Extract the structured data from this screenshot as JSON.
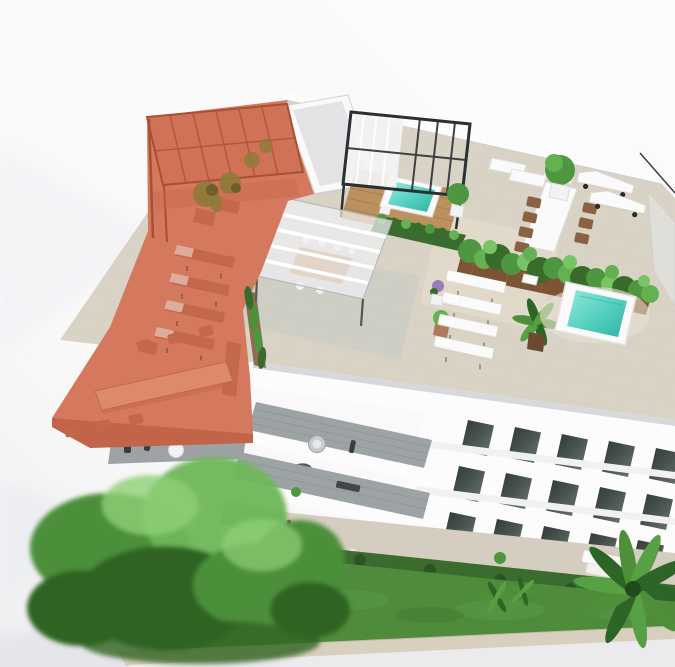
{
  "scene": {
    "type": "aerial 3d architectural rendering",
    "subject": "white residential building with furnished rooftop terraces and gardens",
    "background": "plain white studio backdrop",
    "highlighted_unit": {
      "position": "rooftop upper-left terrace",
      "state": "selected",
      "tint": "#d4795e",
      "furniture": [
        "slatted pergola",
        "potted trees x2",
        "sun loungers x4",
        "dining table",
        "chairs x6",
        "side benches"
      ]
    },
    "rooftop_features": [
      "white skylight box",
      "black glass pergola",
      "timber deck",
      "plunge pool 1",
      "white slat pergola",
      "pergola dining table with chairs",
      "long dining table",
      "brown chairs",
      "hedge planter",
      "large timber planter with shrubs",
      "white sun loungers x4",
      "wheeled loungers x2",
      "daybeds x2",
      "potted palm",
      "lavender pots",
      "potted shrubs",
      "plunge pool 2",
      "glass edge railing",
      "ornamental grasses"
    ],
    "facade_features": [
      "roof fascia",
      "dark window rows x3",
      "floor slab bands",
      "stepped balcony terraces x3",
      "hanging chair",
      "balcony rug",
      "balcony figures",
      "round table"
    ],
    "ground_features": [
      "stone patio",
      "white outdoor sofa",
      "round poufs",
      "cafe table and chairs",
      "figure in red",
      "hedge row",
      "lawn",
      "small palms x2",
      "large tree",
      "tall palm",
      "beige boundary wall"
    ]
  },
  "colors": {
    "bg": "#fbfafa",
    "bgSoft": "#f2f1f4",
    "shadowSoft": "#e4e5e9",
    "groundStrip": "#ebebee",
    "wallBeige": "#d9cfbe",
    "patio": "#d5cec0",
    "lawn": "#4e8c3c",
    "lawnLight": "#5da04a",
    "lawnDark": "#3f7a30",
    "hedge": "#3a6b2f",
    "hedgeDark": "#2c5424",
    "treeDark": "#2f6423",
    "treeMid": "#4c8f3a",
    "treeLight": "#6fb659",
    "treeTip": "#8fd077",
    "palmDark": "#2d6526",
    "palmMid": "#4e9039",
    "palmLight": "#57a044",
    "roofPaver": "#d9d3c6",
    "paverLine": "#c6c0b2",
    "paverCool": "#c4c8c3",
    "paverWarm": "#e7e0d0",
    "white": "#fafafa",
    "fascia": "#fcfcfd",
    "slabShadow": "#c9c9cd",
    "glass": "#e7eaec",
    "pergolaFrame": "#2c2f32",
    "deckWood": "#bb9160",
    "deckWoodLine": "#a67c4e",
    "planterWood": "#7d5434",
    "potBrown": "#6b4a30",
    "terracotta": "#b07a5a",
    "water": "#52cfbe",
    "waterLight": "#93e9da",
    "waterDeep": "#2fb4a4",
    "windowDark": "#36403b",
    "windowLight": "#5d6b64",
    "balconyDeck": "#9da3a4",
    "balconyDeckLine": "#8b9192",
    "furnDark": "#383d41",
    "accentRed": "#c43b2e",
    "chairBrown": "#8a6242",
    "green1": "#4e9740",
    "green2": "#376c2a",
    "green3": "#64b152",
    "green4": "#79c465",
    "highlight": "#d4795e",
    "highlightDark": "#c2644a",
    "highlightDeep": "#a94f35",
    "highlightMid": "#cf7257",
    "highlightLight": "#dd8a6c",
    "highlightFurn": "#c4684b",
    "highlightShadow": "#b5573c",
    "olive": "#8f7a3a",
    "oliveDark": "#6f5d2c",
    "purple": "#9a7cb8",
    "potWhite": "#f2f2f3",
    "grayFurn": "#c6cbce"
  }
}
